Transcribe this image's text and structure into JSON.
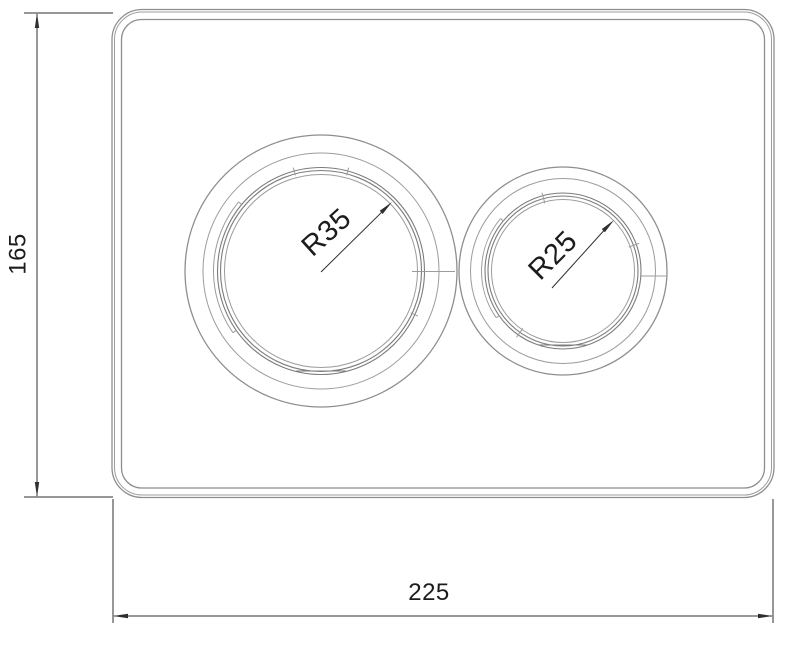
{
  "page": {
    "background": "#ffffff"
  },
  "drawing": {
    "kind": "technical-dimension-drawing",
    "subject": "Dual-flush toilet wall plate with two round push buttons",
    "units": "mm",
    "colors": {
      "plate_outline": "#8e8e8e",
      "outline_light": "#9c9c9c",
      "ring_outline": "#7c7c7c",
      "dimension_lines": "#2f2f2f",
      "text": "#1c1c1c",
      "background": "#ffffff"
    },
    "dimensions": {
      "plate_width": "225",
      "plate_height": "165",
      "large_button_radius": "R35",
      "small_button_radius": "R25"
    }
  }
}
